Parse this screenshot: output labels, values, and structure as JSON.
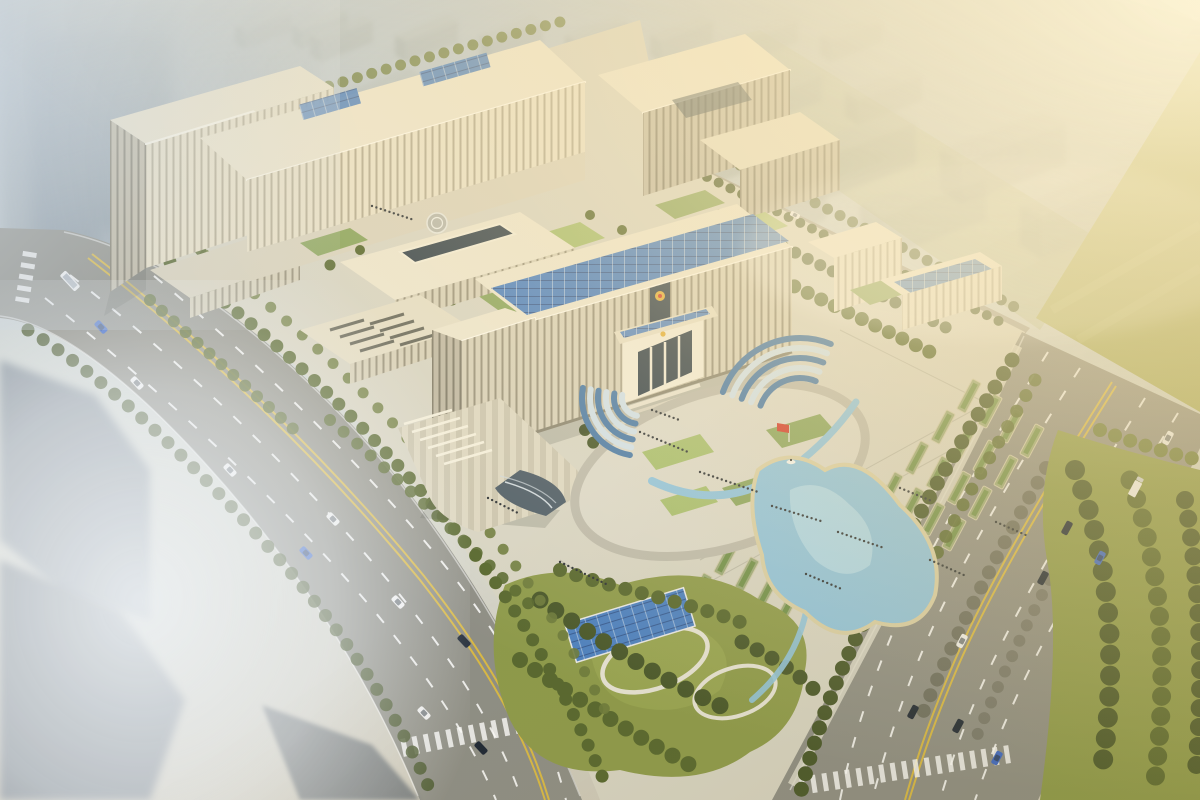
{
  "scene": {
    "type": "aerial architectural rendering",
    "subject": "large government office complex with entrance plaza, terraced gardens, pond, central park and tree-lined boulevards",
    "view": "bird's-eye isometric view in hazy morning light",
    "lighting": "sun glow with god rays from the upper-right corner, fog over the city at left"
  },
  "colors": {
    "sky_top": "#aab7c0",
    "sky_mid": "#c8d0d2",
    "ground": "#d7d4c4",
    "road": "#8e8e86",
    "road_far": "#a09e94",
    "lane_yellow": "#d9b945",
    "pavement_light": "#e1ded0",
    "building_cream": "#efe8d3",
    "building_lit": "#f6f1de",
    "building_shade": "#bfb8a4",
    "roof_light": "#ece5cf",
    "glass_dark": "#34424c",
    "solar_blue": "#4b80c2",
    "lawn": "#a6bd6e",
    "lawn_dark": "#8aa45e",
    "tree_olive": "#57672f",
    "tree_dark": "#47562a",
    "park_grass": "#8d9a4b",
    "field_olive": "#a9ad60",
    "pond": "#8fc3de",
    "pond_light": "#b5dcec",
    "sand": "#d9cfa6",
    "flag_red": "#d2392b",
    "emblem_gold": "#e2af3a",
    "people": "#2c3136",
    "car_white": "#f2f2f2",
    "car_blue": "#3a66c8",
    "car_dark": "#1d2736",
    "haze_city": "#9aa5ab",
    "fog": "#eef2f5",
    "sun": "#fff6d8"
  },
  "landmarks": {
    "national_emblem_count": 2,
    "red_flag_count": 1,
    "helipad_count": 1,
    "boat_count": 1,
    "fountain_cascades": 2,
    "pond_count": 1,
    "solar_roof_arrays": 5,
    "garden_planters": 28,
    "pedestrian_groups": 12
  },
  "vehicles": {
    "left_road": [
      {
        "type": "bus",
        "color": "white"
      },
      {
        "type": "car",
        "color": "blue"
      },
      {
        "type": "car",
        "color": "white"
      },
      {
        "type": "car",
        "color": "white"
      },
      {
        "type": "car",
        "color": "blue"
      },
      {
        "type": "car",
        "color": "white"
      },
      {
        "type": "car",
        "color": "white"
      },
      {
        "type": "car",
        "color": "dark"
      },
      {
        "type": "car",
        "color": "white"
      },
      {
        "type": "car",
        "color": "dark"
      }
    ],
    "right_road": [
      {
        "type": "car",
        "color": "white"
      },
      {
        "type": "truck",
        "color": "white"
      },
      {
        "type": "car",
        "color": "dark"
      },
      {
        "type": "car",
        "color": "blue"
      },
      {
        "type": "car",
        "color": "dark"
      },
      {
        "type": "car",
        "color": "white"
      },
      {
        "type": "car",
        "color": "dark"
      },
      {
        "type": "car",
        "color": "dark"
      },
      {
        "type": "car",
        "color": "blue"
      }
    ],
    "rear_road": [
      {
        "type": "car",
        "color": "white"
      }
    ]
  },
  "environment": {
    "street_and_park_trees": "~200 round street / park trees",
    "background": "rows of hazy high-rise apartment blocks fading into sunlight",
    "foreground": "blurred grey buildings in fog at lower left"
  }
}
